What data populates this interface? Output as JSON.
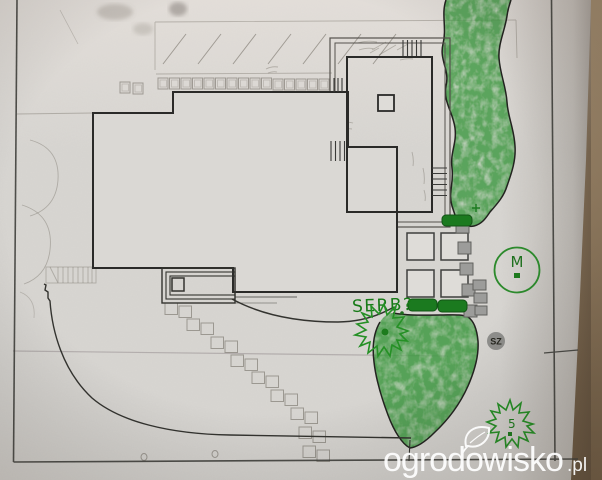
{
  "photo": {
    "subject": "hand-drawn garden landscape plan on paper, photographed on a brown table"
  },
  "labels": {
    "shrub_note": "SERB?",
    "tree_circle": "M",
    "round_badge": "SZ",
    "small_bush": "5"
  },
  "watermark": {
    "site": "ogrodowisko",
    "suffix": ".pl"
  },
  "colors": {
    "table": "#8c7455",
    "paper": "#d8d6d2",
    "plan_ink": "#33332f",
    "pencil": "#8e887e",
    "crayon_green": "#2f9032",
    "hedge_green": "#1b7a1f",
    "marker_green": "#2c8a2c",
    "badge_fill": "#8f8f8c",
    "watermark_white": "#ffffff"
  }
}
